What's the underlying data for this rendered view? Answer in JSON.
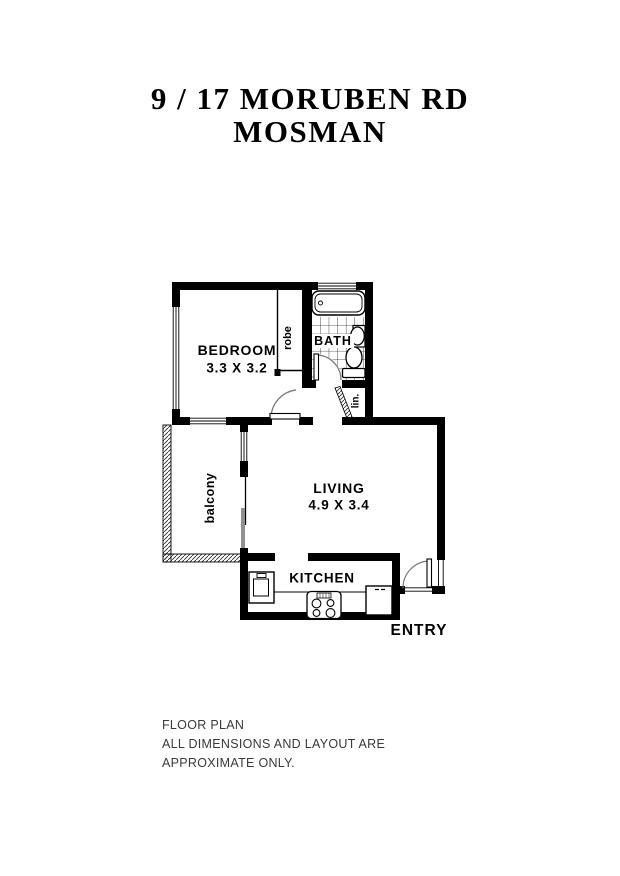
{
  "title": {
    "line1": "9 / 17 MORUBEN RD",
    "line2": "MOSMAN"
  },
  "rooms": {
    "bedroom": {
      "name": "BEDROOM",
      "dims": "3.3 X 3.2"
    },
    "bath": {
      "name": "BATH"
    },
    "robe": {
      "name": "robe"
    },
    "linen": {
      "name": "lin."
    },
    "living": {
      "name": "LIVING",
      "dims": "4.9 X 3.4"
    },
    "kitchen": {
      "name": "KITCHEN"
    },
    "balcony": {
      "name": "balcony"
    },
    "entry": {
      "name": "ENTRY"
    }
  },
  "fixtures": [
    "bathtub",
    "basin",
    "toilet",
    "tiled-floor",
    "kitchen-sink",
    "stove",
    "fridge",
    "counter",
    "sliding-door",
    "linen-bifold-door",
    "bedroom-door",
    "bath-door",
    "entry-door",
    "balcony-railing",
    "windows"
  ],
  "footer": {
    "line1": "FLOOR PLAN",
    "line2": "ALL DIMENSIONS AND LAYOUT ARE",
    "line3": "APPROXIMATE ONLY."
  },
  "colors": {
    "wall": "#000000",
    "background": "#ffffff",
    "door_arc": "#777777",
    "slider_panel": "#909090",
    "footer_text": "#3a3a3a"
  }
}
